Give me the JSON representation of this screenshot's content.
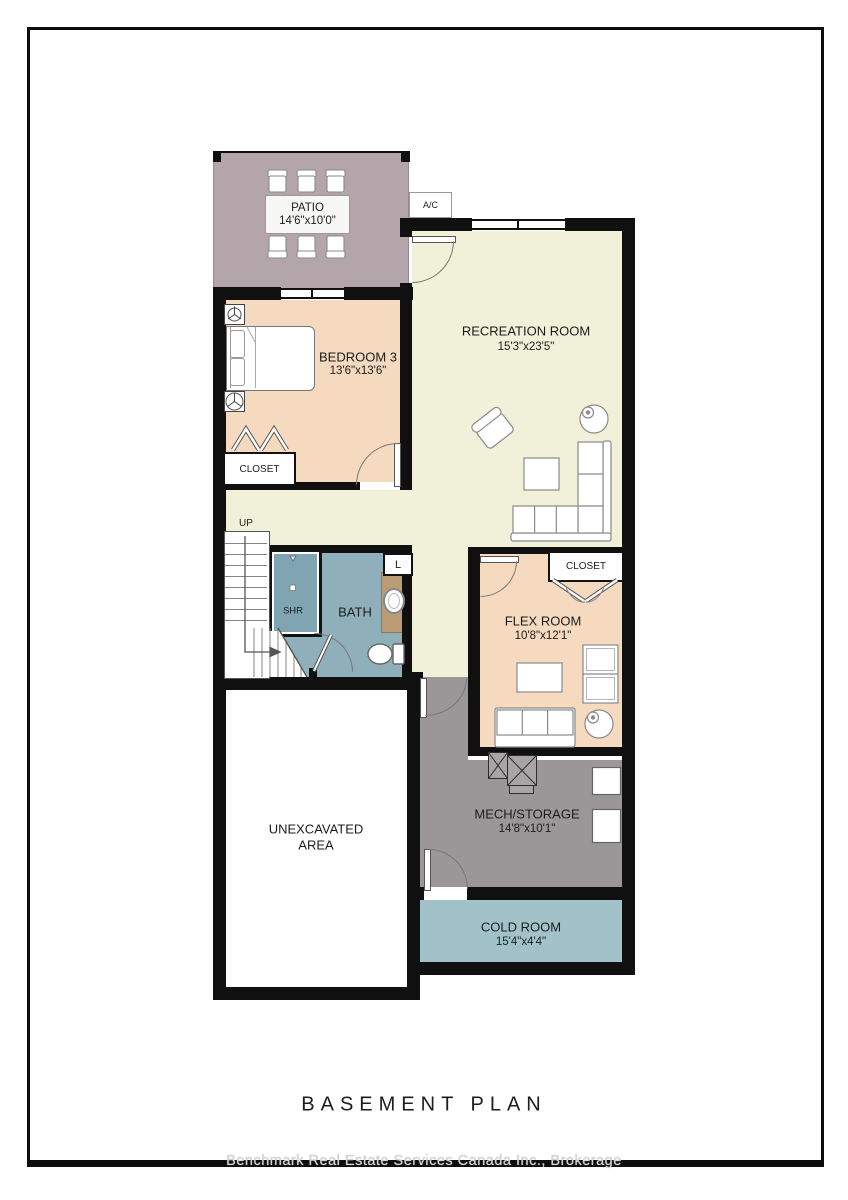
{
  "title": {
    "text": "BASEMENT PLAN"
  },
  "watermark": {
    "text": "Benchmark Real Estate Services Canada Inc., Brokerage"
  },
  "rooms": {
    "patio": {
      "name": "PATIO",
      "dims": "14'6\"x10'0\""
    },
    "recreation": {
      "name": "RECREATION ROOM",
      "dims": "15'3\"x23'5\""
    },
    "bedroom3": {
      "name": "BEDROOM 3",
      "dims": "13'6\"x13'6\""
    },
    "flex": {
      "name": "FLEX ROOM",
      "dims": "10'8\"x12'1\""
    },
    "mech": {
      "name": "MECH/STORAGE",
      "dims": "14'8\"x10'1\""
    },
    "cold": {
      "name": "COLD ROOM",
      "dims": "15'4\"x4'4\""
    },
    "unexcavated": {
      "line1": "UNEXCAVATED",
      "line2": "AREA"
    },
    "bath": {
      "name": "BATH"
    },
    "shower": {
      "name": "SHR"
    },
    "laundry": {
      "name": "L"
    },
    "bedroom_closet": {
      "name": "CLOSET"
    },
    "flex_closet": {
      "name": "CLOSET"
    },
    "stairs": {
      "direction": "UP"
    },
    "ac": {
      "name": "A/C"
    }
  },
  "colors": {
    "patio": "#b4a5ab",
    "recreation": "#f1f1d9",
    "bedroom": "#f5dabf",
    "flex": "#f5dabf",
    "bath": "#8fb0ba",
    "shower_interior": "#7ea5b1",
    "vanity_counter": "#bc9b77",
    "mech": "#9b9799",
    "cold": "#a2c2c9",
    "walls": "#101010",
    "watermark_text": "#d4d4d4"
  }
}
